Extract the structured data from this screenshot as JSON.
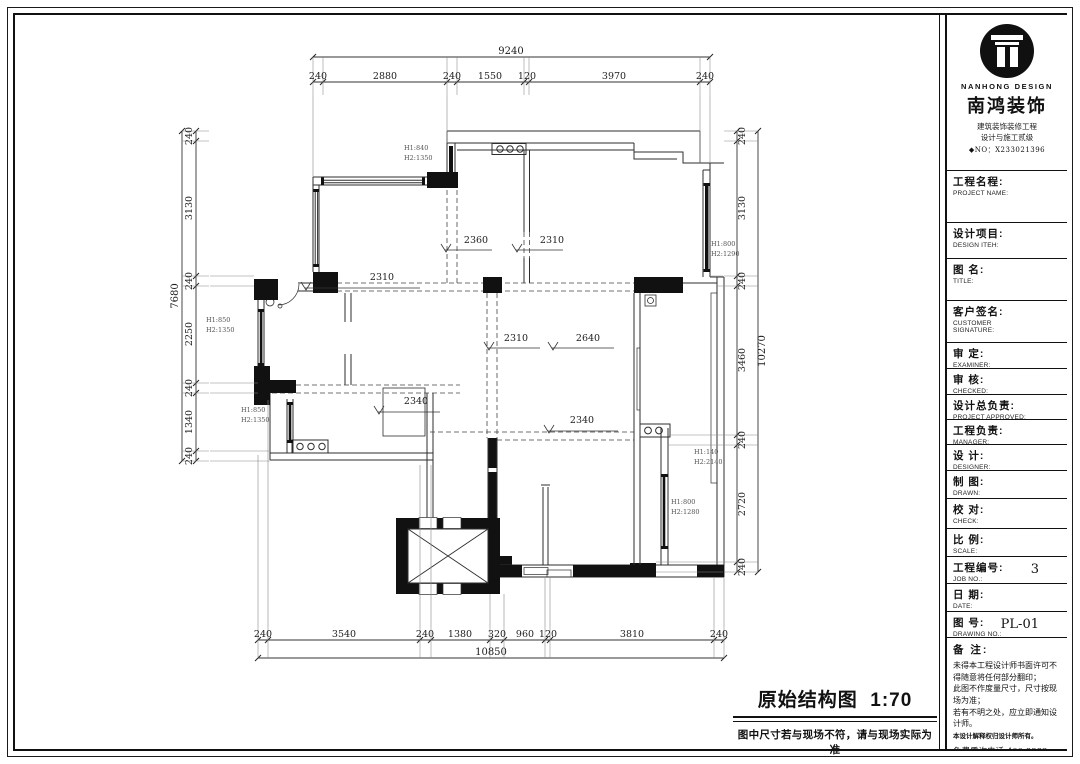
{
  "title_block": {
    "brand": {
      "logo_en": "NANHONG DESIGN",
      "logo_cn": "南鸿装饰",
      "cert1": "建筑装饰装修工程",
      "cert2": "设计与施工贰级",
      "cert_no": "◆NO：X233021396"
    },
    "fields": [
      {
        "cn": "工程名程:",
        "en": "PROJECT NAME:",
        "value": "",
        "h": 52
      },
      {
        "cn": "设计项目:",
        "en": "DESIGN ITEH:",
        "value": "",
        "h": 36
      },
      {
        "cn": "图  名:",
        "en": "TITLE:",
        "value": "",
        "h": 42
      },
      {
        "cn": "客户签名:",
        "en": "CUSTOMER\nSIGNATURE:",
        "value": "",
        "h": 42
      },
      {
        "cn": "审  定:",
        "en": "EXAMINER:",
        "value": "",
        "h": 26
      },
      {
        "cn": "审  核:",
        "en": "CHECKED:",
        "value": "",
        "h": 26
      },
      {
        "cn": "设计总负责:",
        "en": "PROJECT APPROVED:",
        "value": "",
        "h": 25
      },
      {
        "cn": "工程负责:",
        "en": "MANAGER:",
        "value": "",
        "h": 25
      },
      {
        "cn": "设  计:",
        "en": "DESIGNER:",
        "value": "",
        "h": 26
      },
      {
        "cn": "制  图:",
        "en": "DRAWN:",
        "value": "",
        "h": 28
      },
      {
        "cn": "校  对:",
        "en": "CHECK:",
        "value": "",
        "h": 30
      },
      {
        "cn": "比  例:",
        "en": "SCALE:",
        "value": "",
        "h": 28
      },
      {
        "cn": "工程编号:",
        "en": "JOB NO.:",
        "value": "3",
        "h": 27
      },
      {
        "cn": "日  期:",
        "en": "DATE:",
        "value": "",
        "h": 28
      },
      {
        "cn": "图  号:",
        "en": "DRAWING NO.:",
        "value": "PL-01",
        "h": 26
      }
    ],
    "notes": {
      "label": "备 注:",
      "lines": [
        "未得本工程设计师书面许可不得随意将任何部分翻印；",
        "此图不作度量尺寸，尺寸按现场为准；",
        "若有不明之处，应立即通知设计师。"
      ],
      "fine_print": "本设计解释权归设计师所有。",
      "phone": "免费质询电话:400 8383 168"
    }
  },
  "drawing": {
    "caption": "原始结构图",
    "scale": "1:70",
    "caption_note": "图中尺寸若与现场不符，请与现场实际为准"
  },
  "plan": {
    "chains": [
      {
        "name": "top",
        "orient": "h",
        "seg": 82,
        "ov": 57,
        "a": 313,
        "b": 710,
        "dir": 1,
        "ticks": [
          313,
          323,
          447,
          457,
          524,
          529,
          700,
          710
        ],
        "labels": [
          [
            "240",
            318
          ],
          [
            "2880",
            385
          ],
          [
            "240",
            452
          ],
          [
            "1550",
            490
          ],
          [
            "120",
            527
          ],
          [
            "3970",
            614
          ],
          [
            "240",
            705
          ]
        ],
        "ov_text": "9240",
        "ov_at": 511
      },
      {
        "name": "bottom",
        "orient": "h",
        "seg": 640,
        "ov": 658,
        "a": 258,
        "b": 724,
        "dir": -1,
        "ticks": [
          258,
          268,
          420,
          431,
          490,
          504,
          545,
          550,
          714,
          724
        ],
        "labels": [
          [
            "240",
            263
          ],
          [
            "3540",
            344
          ],
          [
            "240",
            425
          ],
          [
            "1380",
            460
          ],
          [
            "320",
            497
          ],
          [
            "960",
            525
          ],
          [
            "120",
            548
          ],
          [
            "3810",
            632
          ],
          [
            "240",
            719
          ]
        ],
        "ov_text": "10850",
        "ov_at": 491
      },
      {
        "name": "left",
        "orient": "v",
        "seg": 196,
        "ov": 182,
        "a": 131,
        "b": 461,
        "dir": 1,
        "lx": 192,
        "ov_lx": 178,
        "ticks": [
          131,
          141,
          276,
          286,
          383,
          393,
          451,
          461
        ],
        "labels": [
          [
            "240",
            136
          ],
          [
            "3130",
            208
          ],
          [
            "240",
            281
          ],
          [
            "2250",
            334
          ],
          [
            "240",
            388
          ],
          [
            "1340",
            422
          ],
          [
            "240",
            456
          ]
        ],
        "ov_text": "7680",
        "ov_at": 296
      },
      {
        "name": "right",
        "orient": "v",
        "seg": 737,
        "ov": 758,
        "a": 131,
        "b": 572,
        "dir": -1,
        "lx": 745,
        "ov_lx": 765,
        "ticks": [
          131,
          141,
          276,
          286,
          435,
          445,
          562,
          572
        ],
        "labels": [
          [
            "240",
            136
          ],
          [
            "3130",
            208
          ],
          [
            "240",
            281
          ],
          [
            "3460",
            360
          ],
          [
            "240",
            440
          ],
          [
            "2720",
            504
          ],
          [
            "240",
            567
          ]
        ],
        "ov_text": "10270",
        "ov_at": 351
      }
    ],
    "callouts": [
      {
        "t": "2360",
        "tx": 476,
        "ty": 243,
        "x1": 445,
        "y": 250,
        "x2": 492
      },
      {
        "t": "2310",
        "tx": 552,
        "ty": 243,
        "x1": 516,
        "y": 250,
        "x2": 563
      },
      {
        "t": "2310",
        "tx": 382,
        "ty": 280,
        "x1": 305,
        "y": 288,
        "x2": 420
      },
      {
        "t": "2310",
        "tx": 516,
        "ty": 341,
        "x1": 488,
        "y": 348,
        "x2": 540
      },
      {
        "t": "2640",
        "tx": 588,
        "ty": 341,
        "x1": 552,
        "y": 348,
        "x2": 614
      },
      {
        "t": "2340",
        "tx": 416,
        "ty": 404,
        "x1": 378,
        "y": 412,
        "x2": 440
      },
      {
        "t": "2340",
        "tx": 582,
        "ty": 423,
        "x1": 548,
        "y": 431,
        "x2": 618
      }
    ],
    "height_labels": [
      {
        "l1": "H1:840",
        "l2": "H2:1350",
        "x": 404,
        "y": 150
      },
      {
        "l1": "H1:800",
        "l2": "H2:1290",
        "x": 711,
        "y": 246
      },
      {
        "l1": "H1:850",
        "l2": "H2:1350",
        "x": 206,
        "y": 322
      },
      {
        "l1": "H1:850",
        "l2": "H2:1350",
        "x": 241,
        "y": 412
      },
      {
        "l1": "H1:140",
        "l2": "H2:2140",
        "x": 694,
        "y": 454
      },
      {
        "l1": "H1:800",
        "l2": "H2:1280",
        "x": 671,
        "y": 504
      }
    ]
  }
}
